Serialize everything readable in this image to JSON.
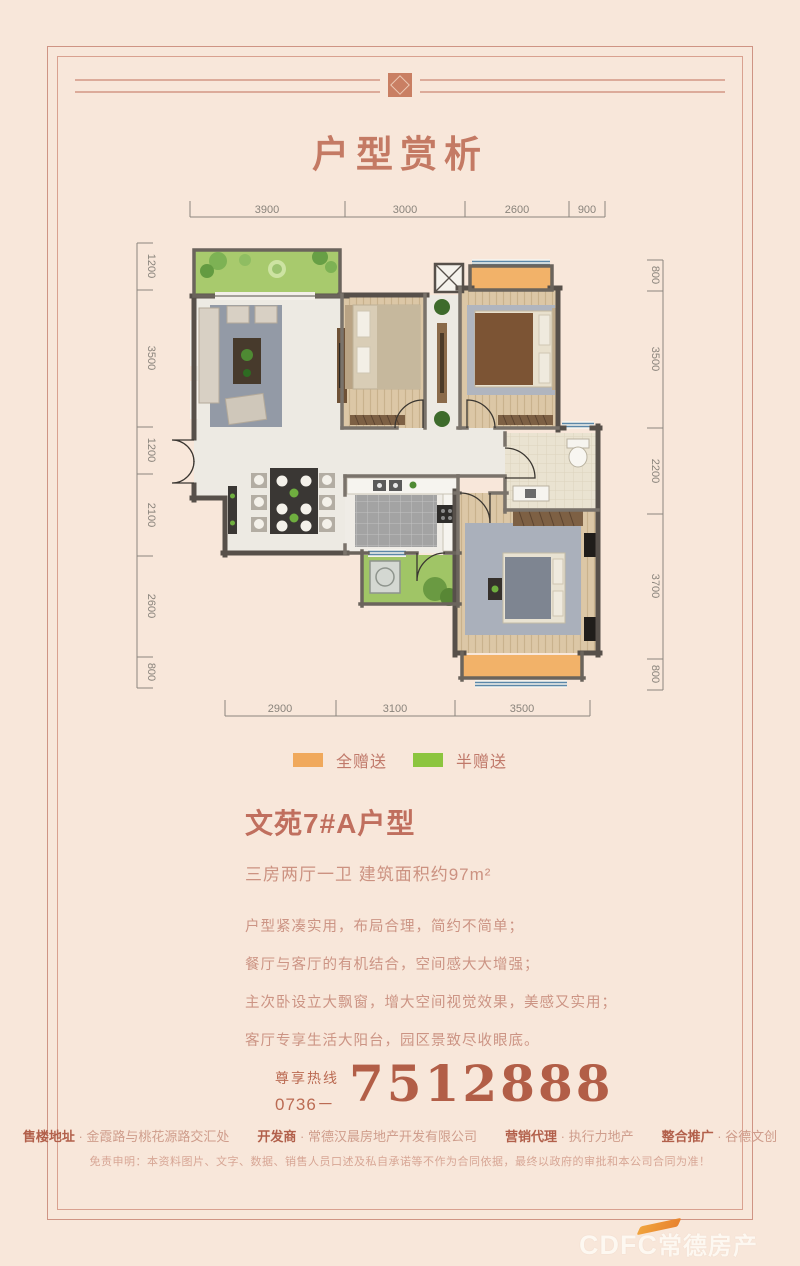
{
  "page": {
    "title": "户型赏析"
  },
  "floorplan": {
    "dims_top": [
      "3900",
      "3000",
      "2600",
      "900"
    ],
    "dims_bottom": [
      "2900",
      "3100",
      "3500"
    ],
    "dims_left": [
      "1200",
      "3500",
      "1200",
      "2100",
      "2600",
      "800"
    ],
    "dims_right": [
      "800",
      "3500",
      "2200",
      "3700",
      "800"
    ]
  },
  "legend": {
    "full_gift": {
      "label": "全赠送",
      "color": "#f0a95c"
    },
    "half_gift": {
      "label": "半赠送",
      "color": "#8cc53f"
    }
  },
  "unit": {
    "name": "文苑7#A户型",
    "spec": "三房两厅一卫 建筑面积约97m²",
    "features": [
      "户型紧凑实用，布局合理，简约不简单；",
      "餐厅与客厅的有机结合，空间感大大增强；",
      "主次卧设立大飘窗，增大空间视觉效果，美感又实用；",
      "客厅专享生活大阳台，园区景致尽收眼底。"
    ]
  },
  "hotline": {
    "label": "尊享热线",
    "area_code": "0736－",
    "number": "7512888"
  },
  "footer": {
    "items": [
      {
        "label": "售楼地址",
        "value": "金霞路与桃花源路交汇处"
      },
      {
        "label": "开发商",
        "value": "常德汉晨房地产开发有限公司"
      },
      {
        "label": "营销代理",
        "value": "执行力地产"
      },
      {
        "label": "整合推广",
        "value": "谷德文创"
      }
    ],
    "disclaimer": "免责申明：本资料图片、文字、数据、销售人员口述及私自承诺等不作为合同依据，最终以政府的审批和本公司合同为准！",
    "separator": "·",
    "logo_en": "CDFC",
    "logo_cn": "常德房产"
  }
}
